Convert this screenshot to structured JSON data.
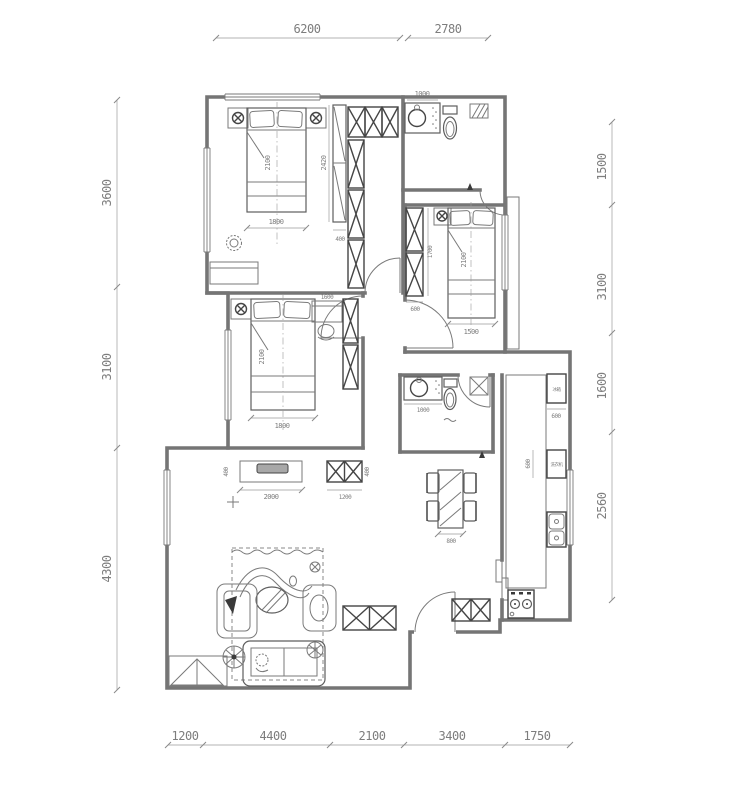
{
  "drawing": {
    "type": "apartment-floor-plan",
    "units": "mm"
  },
  "dims": {
    "top": [
      "6200",
      "2780"
    ],
    "bottom": [
      "1200",
      "4400",
      "2100",
      "3400",
      "1750"
    ],
    "left": [
      "3600",
      "3100",
      "4300"
    ],
    "right": [
      "1500",
      "3100",
      "1600",
      "2560"
    ]
  },
  "rooms": {
    "master": {
      "bed_len": "2100",
      "bed_w": "1800",
      "closet_h": "2420",
      "closet_d": "400"
    },
    "bath1": {
      "vanity": "1000"
    },
    "bed2": {
      "ward_w": "600",
      "ward_l": "1700",
      "bed_len": "2100",
      "bed_w": "1500"
    },
    "bed3": {
      "desk": "1600",
      "bed_len": "2100",
      "bed_w": "1800"
    },
    "bath2": {
      "vanity": "1000"
    },
    "kitchen": {
      "dim1": "600",
      "dim2": "600",
      "fridge": "冰箱",
      "washer": "洗衣机"
    },
    "dining": {
      "table": "800"
    },
    "living": {
      "tv_cab": "2000",
      "side_cab": "1200",
      "depth_l": "400",
      "depth_r": "400"
    }
  }
}
